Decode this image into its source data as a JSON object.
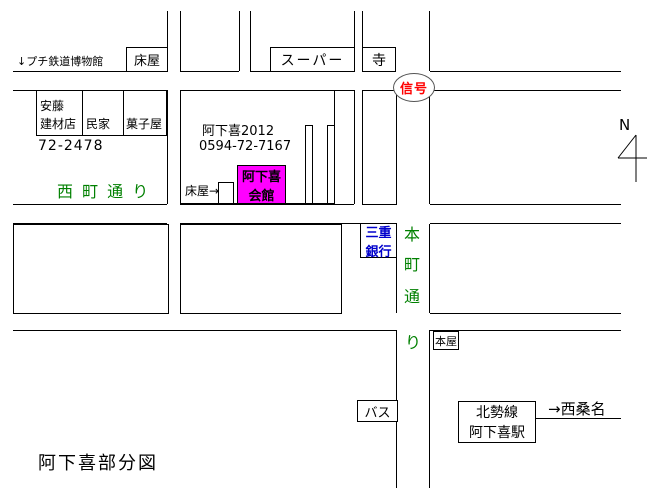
{
  "map": {
    "title": "阿下喜部分図",
    "labels": {
      "museum": "↓プチ鉄道博物館",
      "barber_top": "床屋",
      "supermarket": "スーパー",
      "temple": "寺",
      "signal": "信号",
      "ando_line1": "安藤",
      "ando_line2": "建材店",
      "house": "民家",
      "candy_shop": "菓子屋",
      "ando_phone": "72-2478",
      "nishimachi_street": "西 町 通 り",
      "hall_name_year": "阿下喜2012",
      "hall_phone": "0594-72-7167",
      "barber_arrow": "床屋→",
      "hall_line1": "阿下喜",
      "hall_line2": "会館",
      "bank_line1": "三重",
      "bank_line2": "銀行",
      "honmachi_chars": [
        "本",
        "町",
        "通",
        "り"
      ],
      "bookstore": "本屋",
      "bus": "バス",
      "station_line1": "北勢線",
      "station_line2": "阿下喜駅",
      "to_nishikuwana": "→西桑名",
      "north": "N"
    },
    "colors": {
      "street_name": "#008000",
      "signal_text": "#ff0000",
      "bank_text": "#0000cc",
      "hall_bg": "#ff00ff",
      "line": "#000000"
    }
  }
}
